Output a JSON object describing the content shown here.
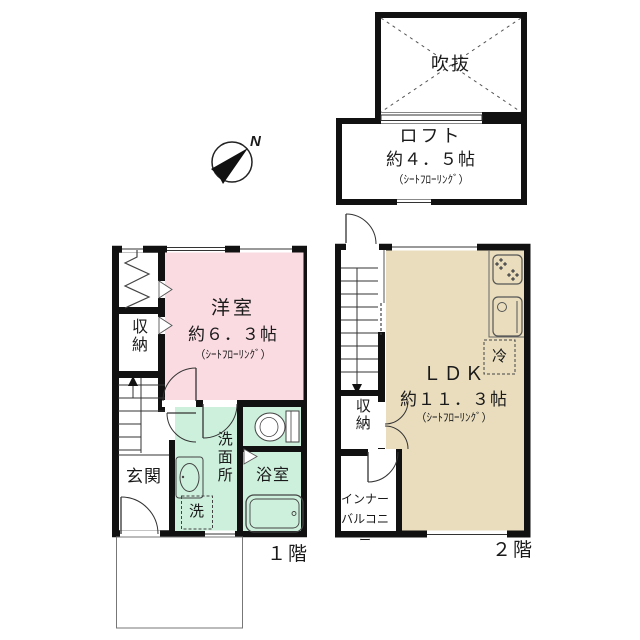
{
  "compass": {
    "north": "N"
  },
  "loft": {
    "void": "吹抜",
    "name": "ロフト",
    "size": "約４．５帖",
    "flooring": "（ｼｰﾄﾌﾛｰﾘﾝｸﾞ）"
  },
  "floor1": {
    "caption": "１階",
    "western_room": {
      "name": "洋室",
      "size": "約６．３帖",
      "flooring": "（ｼｰﾄﾌﾛｰﾘﾝｸﾞ）"
    },
    "storage": "収納",
    "entrance": "玄関",
    "washroom": "洗面所",
    "bathroom": "浴室",
    "washer": "洗"
  },
  "floor2": {
    "caption": "２階",
    "ldk": {
      "name": "ＬＤＫ",
      "size": "約１１．３帖",
      "flooring": "（ｼｰﾄﾌﾛｰﾘﾝｸﾞ）"
    },
    "storage": "収納",
    "inner_balcony": "インナー\nバルコニー",
    "fridge": "冷"
  },
  "colors": {
    "wall": "#111111",
    "western_room_fill": "#fadbe2",
    "ldk_fill": "#e9ddbe",
    "wet_area_fill": "#cdf0dc",
    "line": "#444444"
  }
}
